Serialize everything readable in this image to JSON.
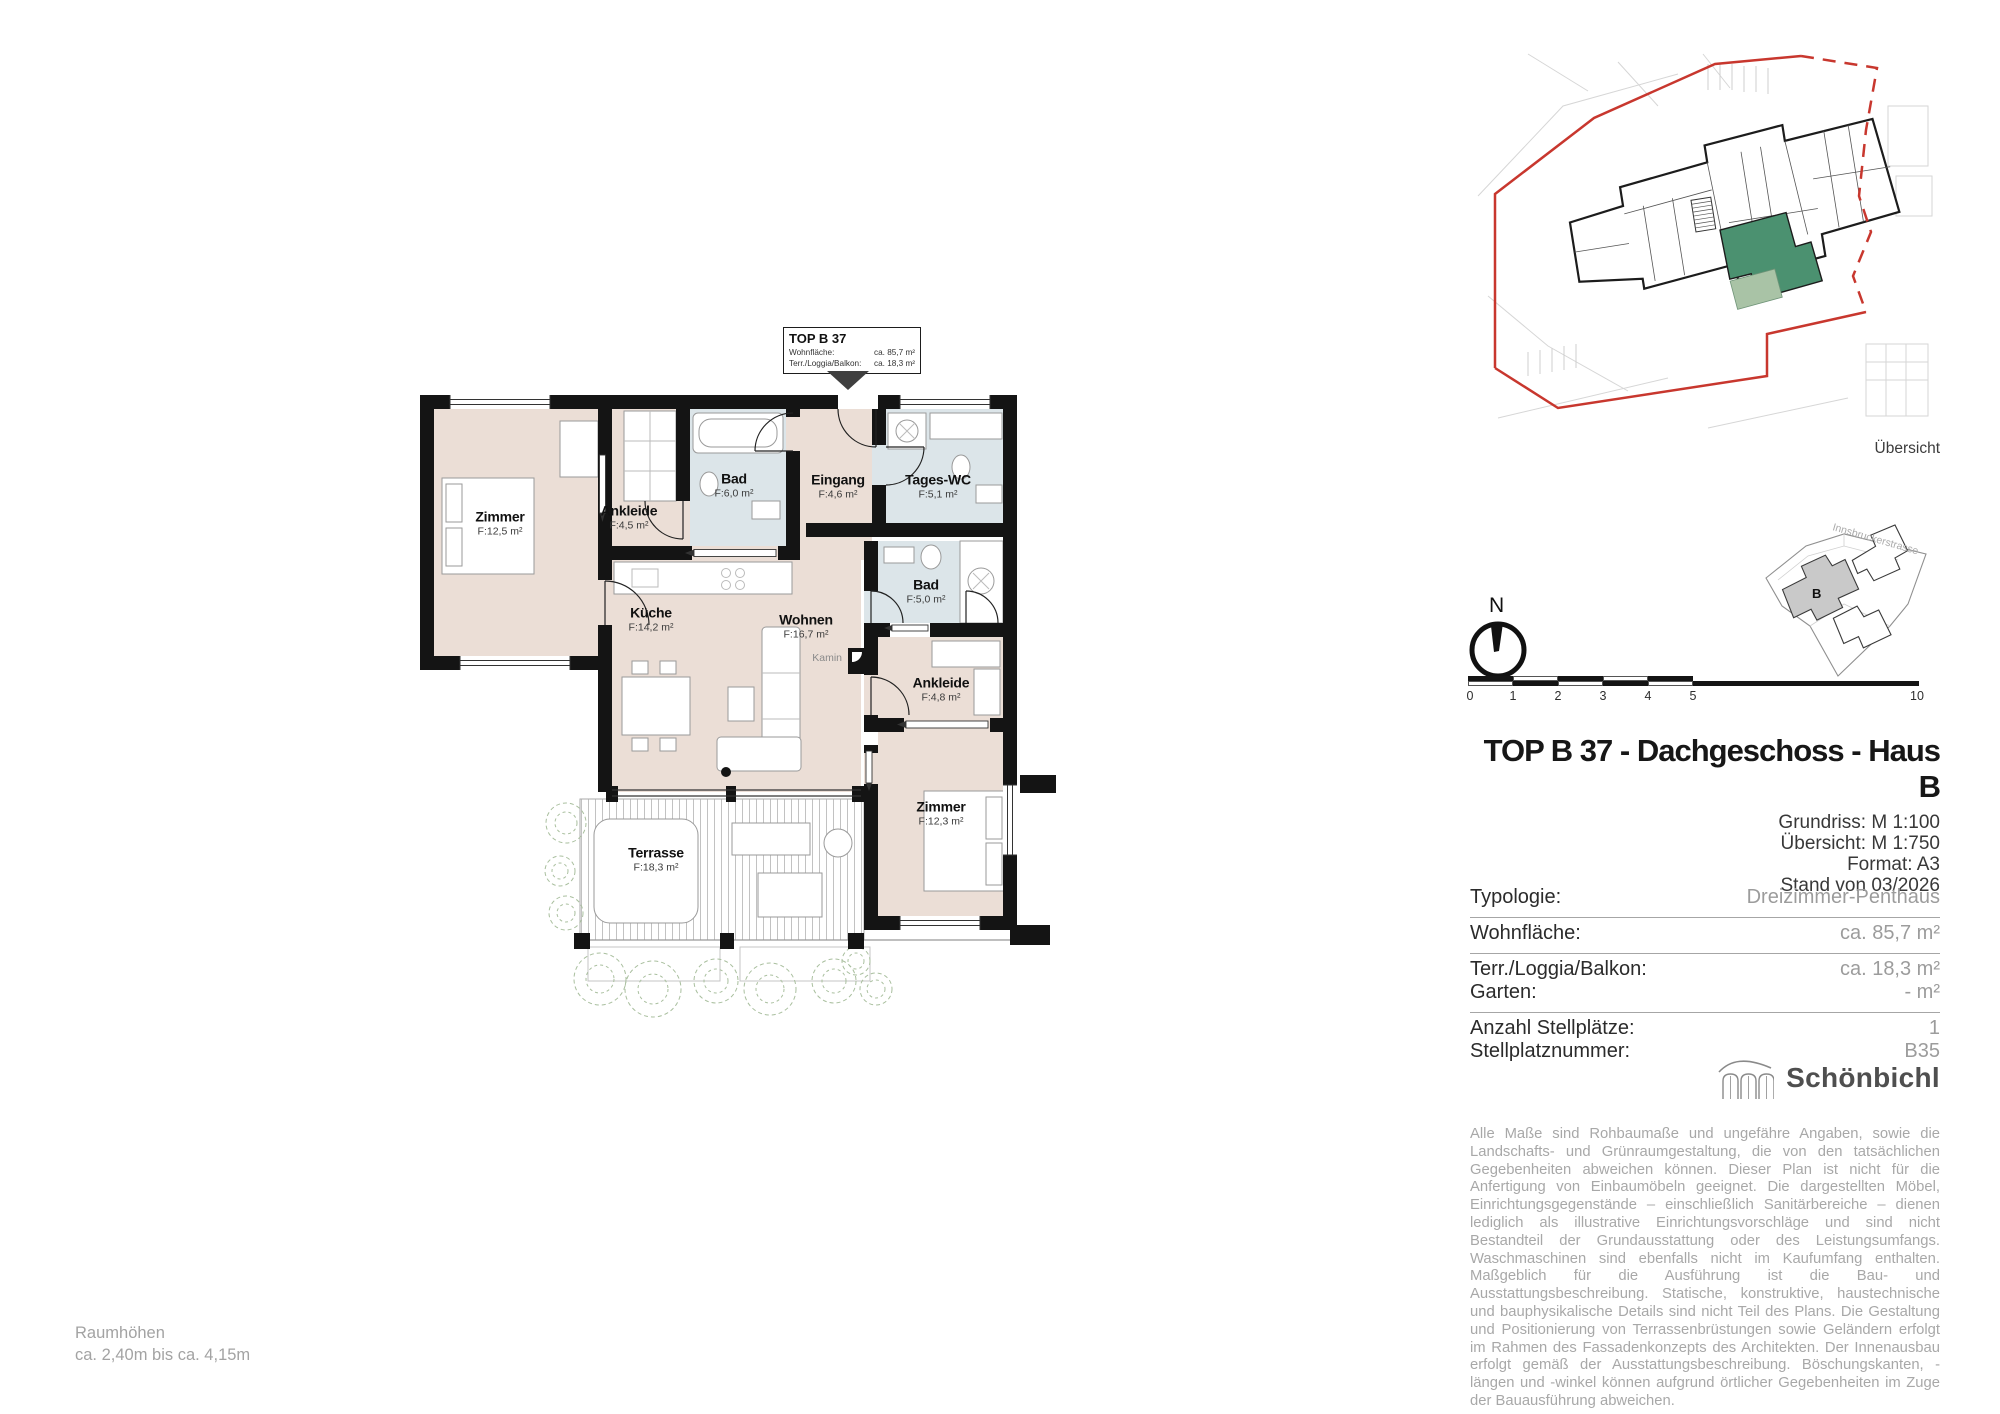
{
  "callout": {
    "title": "TOP B 37",
    "rows": [
      {
        "label": "Wohnfläche:",
        "value": "ca. 85,7 m²"
      },
      {
        "label": "Terr./Loggia/Balkon:",
        "value": "ca. 18,3 m²"
      }
    ]
  },
  "plan": {
    "rooms": [
      {
        "name": "Zimmer",
        "area": "F:12,5 m²"
      },
      {
        "name": "Ankleide",
        "area": "F:4,5 m²"
      },
      {
        "name": "Bad",
        "area": "F:6,0 m²"
      },
      {
        "name": "Eingang",
        "area": "F:4,6 m²"
      },
      {
        "name": "Tages-WC",
        "area": "F:5,1 m²"
      },
      {
        "name": "Küche",
        "area": "F:14,2 m²"
      },
      {
        "name": "Wohnen",
        "area": "F:16,7 m²"
      },
      {
        "name": "Bad",
        "area": "F:5,0 m²"
      },
      {
        "name": "Ankleide",
        "area": "F:4,8 m²"
      },
      {
        "name": "Zimmer",
        "area": "F:12,3 m²"
      },
      {
        "name": "Terrasse",
        "area": "F:18,3 m²"
      }
    ],
    "kamin": "Kamin",
    "colors": {
      "room": "#EBDED6",
      "wet": "#DCE5E9",
      "wall": "#141414"
    }
  },
  "overview": {
    "caption": "Übersicht",
    "boundary_color": "#c8372e",
    "unit_color": "#4b9170",
    "unit_terrace_color": "#a9c3a6"
  },
  "site": {
    "street": "Innsbruckerstrasse",
    "building": "B"
  },
  "compass": {
    "label": "N"
  },
  "scalebar": {
    "ticks": [
      "0",
      "1",
      "2",
      "3",
      "4",
      "5",
      "10"
    ]
  },
  "titleblock": {
    "title": "TOP B 37 - Dachgeschoss - Haus B",
    "details": [
      "Grundriss: M 1:100",
      "Übersicht: M 1:750",
      "Format: A3",
      "Stand von 03/2026"
    ]
  },
  "facts": {
    "groups": [
      [
        {
          "label": "Typologie:",
          "value": "Dreizimmer-Penthaus"
        }
      ],
      [
        {
          "label": "Wohnfläche:",
          "value": "ca. 85,7 m²"
        }
      ],
      [
        {
          "label": "Terr./Loggia/Balkon:",
          "value": "ca. 18,3 m²"
        },
        {
          "label": "Garten:",
          "value": "- m²"
        }
      ],
      [
        {
          "label": "Anzahl Stellplätze:",
          "value": "1"
        },
        {
          "label": "Stellplatznummer:",
          "value": "B35"
        }
      ]
    ]
  },
  "logo": {
    "name": "Schönbichl"
  },
  "disclaimer": "Alle Maße sind Rohbaumaße und ungefähre Angaben, sowie die Landschafts- und Grünraumgestaltung, die von den tatsächlichen Gegebenheiten abweichen können. Dieser Plan ist nicht für die Anfertigung von Einbaumöbeln geeignet. Die dargestellten Möbel, Einrichtungsgegenstände – einschließlich Sanitärbereiche – dienen lediglich als illustrative Einrichtungsvorschläge und sind nicht Bestandteil der Grundausstattung oder des Leistungsumfangs. Waschmaschinen sind ebenfalls nicht im Kaufumfang enthalten. Maßgeblich für die Ausführung ist die Bau- und Ausstattungsbeschreibung. Statische, konstruktive, haustechnische und bauphysikalische Details sind nicht Teil des Plans. Die Gestaltung und Positionierung von Terrassenbrüstungen sowie Geländern erfolgt im Rahmen des Fassadenkonzepts des Architekten. Der Innenausbau erfolgt gemäß der Ausstattungsbeschreibung. Böschungskanten, -längen und -winkel können aufgrund örtlicher Gegebenheiten im Zuge der Bauausführung abweichen.",
  "footer": {
    "line1": "Raumhöhen",
    "line2": "ca. 2,40m bis ca. 4,15m"
  }
}
